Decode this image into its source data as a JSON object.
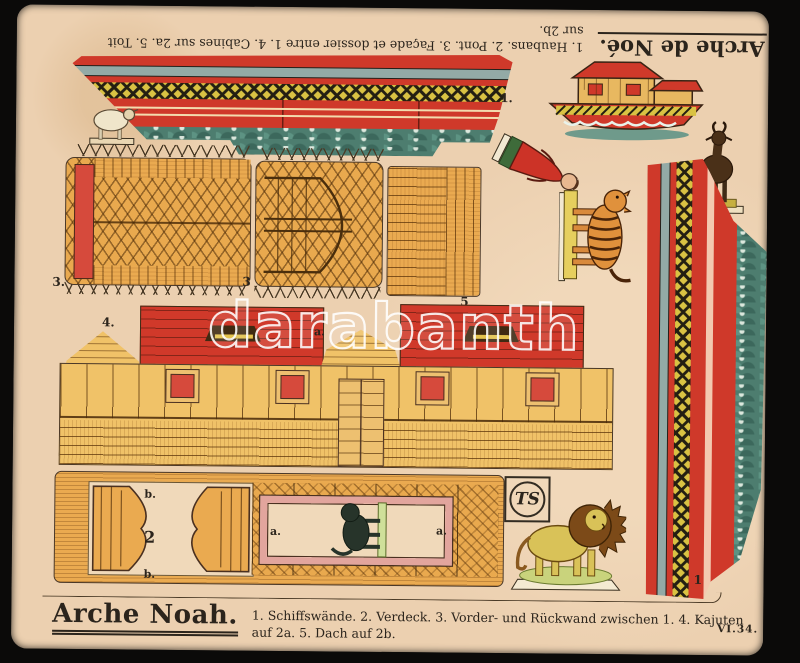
{
  "header_french": {
    "title": "Arche de Noé.",
    "line1": "1. Haubans.  2. Pont.  3. Façade et dossier entre 1.  4. Cabines sur 2a.  5. Toit",
    "line2": "sur 2b."
  },
  "footer_german": {
    "title": "Arche Noah.",
    "line1": "1. Schiffswände.  2. Verdeck.  3. Vorder- und Rückwand zwischen 1.  4. Kajuten",
    "line2": "auf 2a.  5. Dach auf 2b.",
    "plate_number": "VI.34."
  },
  "watermark": "darabanth",
  "labels": {
    "hull": "1.",
    "panel_left": "3.",
    "panel_right": "3",
    "roof": "5",
    "cabin": "4.",
    "cabin_gable": "a.",
    "deck": "2",
    "deck_b_top": "b.",
    "deck_b_bottom": "b.",
    "deck_a_left": "a.",
    "deck_a_right": "a.",
    "side": "1",
    "monogram": "TS"
  },
  "figures": {
    "sheep": "sheep",
    "goat": "goat",
    "tiger": "tiger",
    "lion": "lion",
    "dark_lion": "dark lion",
    "noah": "Noah figure",
    "ark": "assembled ark"
  },
  "colors": {
    "card": "#ecd0b0",
    "background": "#0b0a09",
    "ink": "#2b241c",
    "red": "#cf392a",
    "wood_orange": "#eaaa50",
    "wood_yellow": "#f0c268",
    "blue_grey": "#93aaa6",
    "wave_teal": "#4d7d6f",
    "lattice_yellow": "#d9c243",
    "pink_frame": "#e2a59d"
  }
}
